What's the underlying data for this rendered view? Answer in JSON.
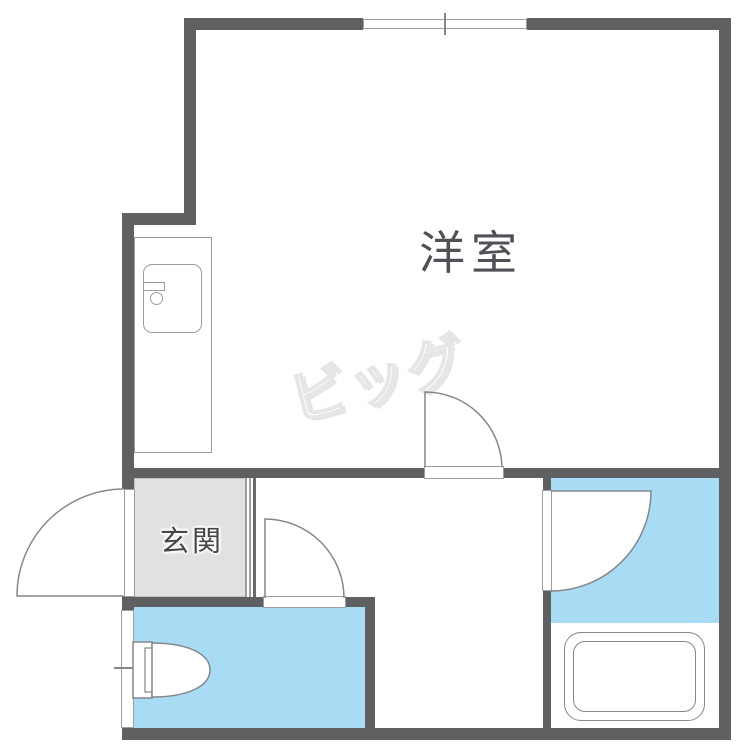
{
  "plan": {
    "title": "apartment-floor-plan",
    "rooms": {
      "western_room": {
        "label": "洋室"
      },
      "entrance": {
        "label": "玄関"
      }
    },
    "watermark": {
      "text": "ビッグ"
    },
    "fixtures": [
      "kitchen-sink-unit",
      "toilet",
      "bathtub",
      "sliding-window-top",
      "small-window-toilet",
      "entrance-swing-door",
      "toilet-swing-door",
      "room-swing-door",
      "bathroom-swing-door"
    ],
    "colors": {
      "wall": "#5e6062",
      "wet_area": "#a8dbf4",
      "entrance_floor": "#e0e1e3",
      "outline": "#85878a",
      "thin_line": "#9b9da0",
      "room_label_text": "#4e5256",
      "entrance_label_text": "#44474a",
      "watermark_outline": "#e6e6e8"
    }
  }
}
